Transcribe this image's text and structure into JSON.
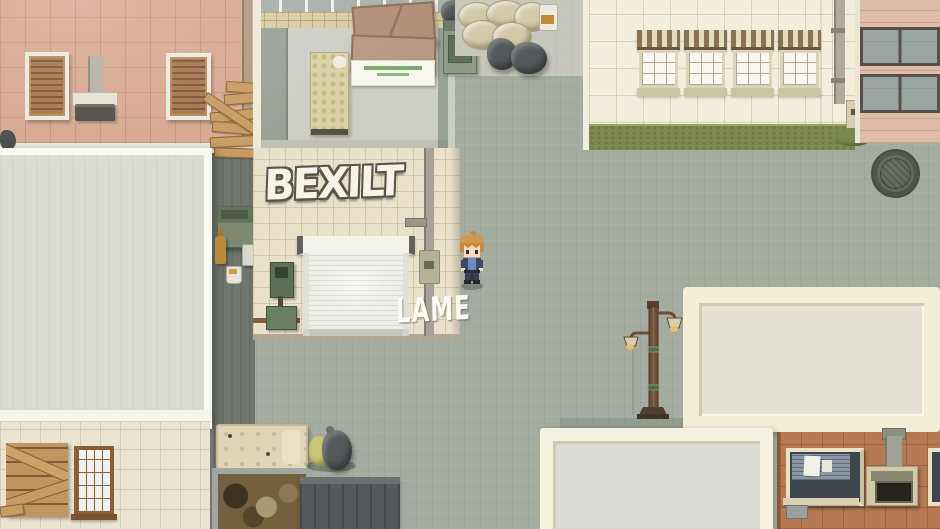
{
  "scene": {
    "name": "Top-down city back alley (RPG map)",
    "graffiti_main": "BEXILT",
    "graffiti_tag": "LAME"
  },
  "player": {
    "sprite": "boy-orange-hair-blue-shirt",
    "facing": "down"
  },
  "palette": {
    "pavement": "#a4aca0",
    "alley_pavement": "#71776f",
    "pink_wall": "#d7a891",
    "cream_wall": "#f3eedb",
    "garage_wall": "#e9e1ca",
    "sand_wall": "#ebe4d1",
    "terracotta_wall": "#b57a51",
    "hedge_green": "#7e8a4f",
    "rooftop_gray": "#d9dbd3",
    "rooftop_border": "#f4eed6",
    "shutter_door": "#efefe9",
    "wood_plank": "#c49a62"
  }
}
